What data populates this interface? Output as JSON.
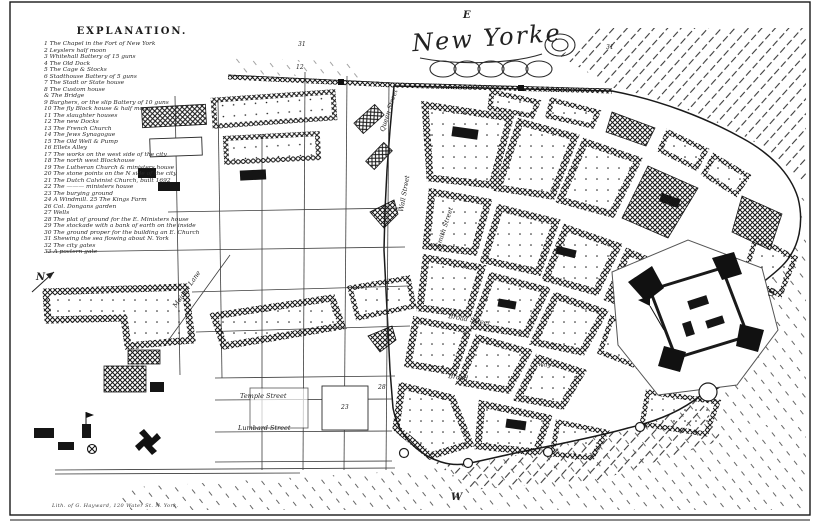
{
  "page": {
    "background": "#ffffff",
    "ink": "#1c1c1c"
  },
  "compass": {
    "east": "E",
    "south": "S",
    "west": "W",
    "north": "N"
  },
  "title": {
    "text": "New Yorke"
  },
  "legend": {
    "heading": "EXPLANATION.",
    "items": [
      "1 The Chapel in the Fort of New York",
      "2 Leyslers half moon",
      "3 Whitehall Battery of 15 guns",
      "4 The Old Dock",
      "5 The Cage & Stocks",
      "6 Stadthouse Battery of 5 guns",
      "7 The Stadt or State house",
      "8 The Custom house",
      "& The Bridge",
      "9 Burghers, or the slip Battery of 10 guns",
      "10 The fly Block house & half moon",
      "11 The slaughter houses",
      "12 The new Docks",
      "13 The French Church",
      "14 The Jews Synagogue",
      "15 The Old Well & Pump",
      "16 Ellets Alley",
      "17 The works on the west side of the city",
      "18 The north west Blockhouse",
      "19 The Lutheran Church & ministers house",
      "20 The stone points on the N side of the city",
      "21 The Dutch Calvinist Church, built 1692",
      "22 The ——— ministers house",
      "23 The burying ground",
      "24 A Windmill. 25 The Kings Farm",
      "26 Col. Dongans garden",
      "27 Wells",
      "28 The plat of ground for the E. Ministers house",
      "29 The stockade with a bank of earth on the inside",
      "30 The ground proper for the building an E. Church",
      "31 Shewing the sea flowing about N. York",
      "32 The city gates",
      "33 A postern gate"
    ]
  },
  "map": {
    "street_labels": [
      {
        "text": "Queen Street"
      },
      {
        "text": "Wall Street"
      },
      {
        "text": "Smith Street"
      },
      {
        "text": "Broad Street"
      },
      {
        "text": "Broad"
      },
      {
        "text": "way"
      },
      {
        "text": "Temple Street"
      },
      {
        "text": "Lumbard Street"
      },
      {
        "text": "Maiden Lane"
      }
    ],
    "reference_numbers": [
      {
        "text": "31"
      },
      {
        "text": "12"
      },
      {
        "text": "31"
      },
      {
        "text": "23"
      },
      {
        "text": "28"
      }
    ],
    "imprint": "Lith. of G. Hayward, 120 Water St. N. York."
  }
}
